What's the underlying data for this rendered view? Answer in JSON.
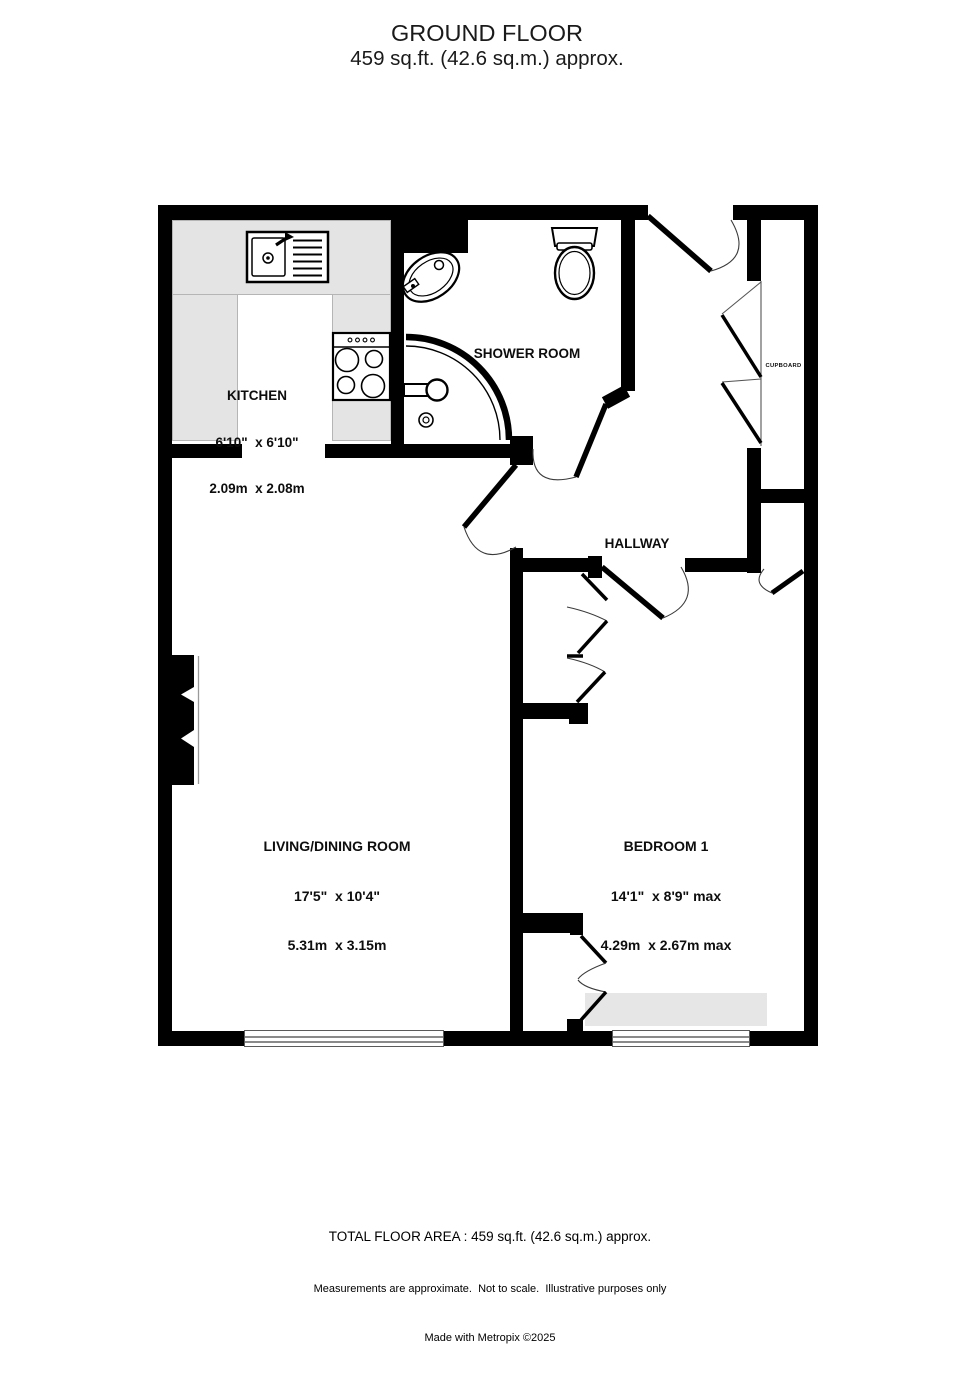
{
  "header": {
    "title": "GROUND FLOOR",
    "subtitle": "459 sq.ft. (42.6 sq.m.) approx."
  },
  "rooms": {
    "kitchen": {
      "name": "KITCHEN",
      "dims_ft": "6'10\"  x 6'10\"",
      "dims_m": "2.09m  x 2.08m"
    },
    "shower_room": {
      "name": "SHOWER ROOM"
    },
    "hallway": {
      "name": "HALLWAY"
    },
    "cupboard": {
      "name": "CUPBOARD"
    },
    "living_dining": {
      "name": "LIVING/DINING ROOM",
      "dims_ft": "17'5\"  x 10'4\"",
      "dims_m": "5.31m  x 3.15m"
    },
    "bedroom1": {
      "name": "BEDROOM 1",
      "dims_ft": "14'1\"  x 8'9\" max",
      "dims_m": "4.29m  x 2.67m max"
    }
  },
  "fixtures": [
    "kitchen-sink",
    "hob-cooker",
    "toilet",
    "basin",
    "corner-shower",
    "chimney-breast",
    "front-door",
    "windows",
    "bifold-cupboard-doors",
    "wardrobe-doors"
  ],
  "footer": {
    "total_area": "TOTAL FLOOR AREA : 459 sq.ft. (42.6 sq.m.) approx.",
    "disclaimer": "Measurements are approximate.  Not to scale.  Illustrative purposes only",
    "credit": "Made with Metropix ©2025"
  },
  "colors": {
    "wall": "#000000",
    "counter": "#e4e4e4",
    "fitted_unit": "#e6e6e6",
    "background": "#ffffff"
  }
}
